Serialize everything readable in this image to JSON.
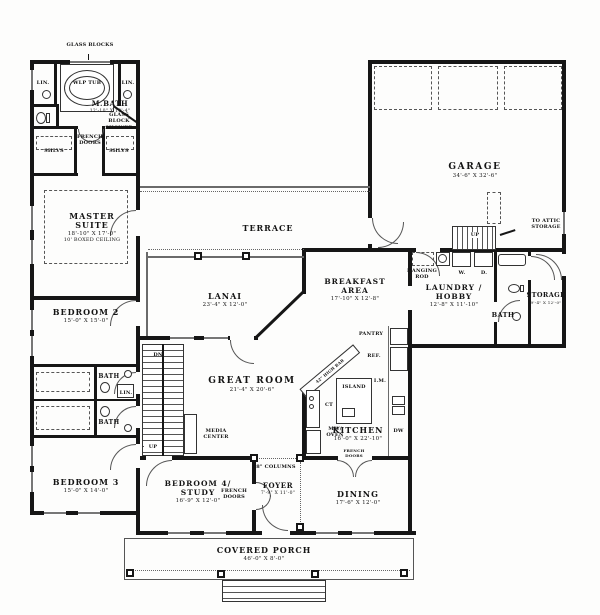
{
  "rooms": {
    "m_bath": {
      "name": "M.BATH",
      "dims": "12'-10\" X 10'-4\""
    },
    "master_suite": {
      "name": "MASTER SUITE",
      "dims": "18'-10\" X 17'-0\"",
      "note": "10' BOXED CEILING"
    },
    "terrace": {
      "name": "TERRACE"
    },
    "garage": {
      "name": "GARAGE",
      "dims": "34'-6\" X 32'-6\""
    },
    "lanai": {
      "name": "LANAI",
      "dims": "23'-4\" X 12'-0\""
    },
    "breakfast_area": {
      "name": "BREAKFAST AREA",
      "dims": "17'-10\" X 12'-8\""
    },
    "laundry_hobby": {
      "name": "LAUNDRY / HOBBY",
      "dims": "12'-8\" X 11'-10\""
    },
    "storage": {
      "name": "STORAGE",
      "dims": "9'-4\" X 12'-0\""
    },
    "bath": {
      "name": "BATH"
    },
    "bedroom_2": {
      "name": "BEDROOM 2",
      "dims": "15'-0\" X 15'-0\""
    },
    "bedroom_3": {
      "name": "BEDROOM 3",
      "dims": "15'-0\" X 14'-0\""
    },
    "bedroom_4": {
      "name": "BEDROOM 4/ STUDY",
      "dims": "16'-9\" X 12'-0\""
    },
    "great_room": {
      "name": "GREAT ROOM",
      "dims": "21'-4\" X 20'-6\""
    },
    "kitchen": {
      "name": "KITCHEN",
      "dims": "16'-0\" X 22'-10\""
    },
    "foyer": {
      "name": "FOYER",
      "dims": "7'-9\" X 11'-0\""
    },
    "dining": {
      "name": "DINING",
      "dims": "17'-6\" X 12'-0\""
    },
    "covered_porch": {
      "name": "COVERED PORCH",
      "dims": "46'-0\" X 8'-0\""
    }
  },
  "annotations": {
    "glass_blocks": "GLASS BLOCKS",
    "wlp_tub": "WLP TUB",
    "lin": "LIN.",
    "french_doors": "FRENCH DOORS",
    "glass_block_shower": "GLASS BLOCK SHOWER",
    "shlvs": "SHLVS",
    "to_attic_storage": "TO ATTIC STORAGE",
    "hanging_rod": "HANGING ROD",
    "washer": "W.",
    "dryer": "D.",
    "up": "UP",
    "dn": "DN",
    "pantry": "PANTRY",
    "refrigerator": "REF.",
    "island": "ISLAND",
    "ice_maker": "I.M.",
    "cooktop": "CT",
    "mw_oven": "MW/ OVEN",
    "dishwasher": "DW",
    "high_bar": "42\" HIGH BAR",
    "media_center": "MEDIA CENTER",
    "columns": "8\" COLUMNS"
  },
  "colors": {
    "wall": "#161616",
    "paper": "#fdfdfc"
  }
}
